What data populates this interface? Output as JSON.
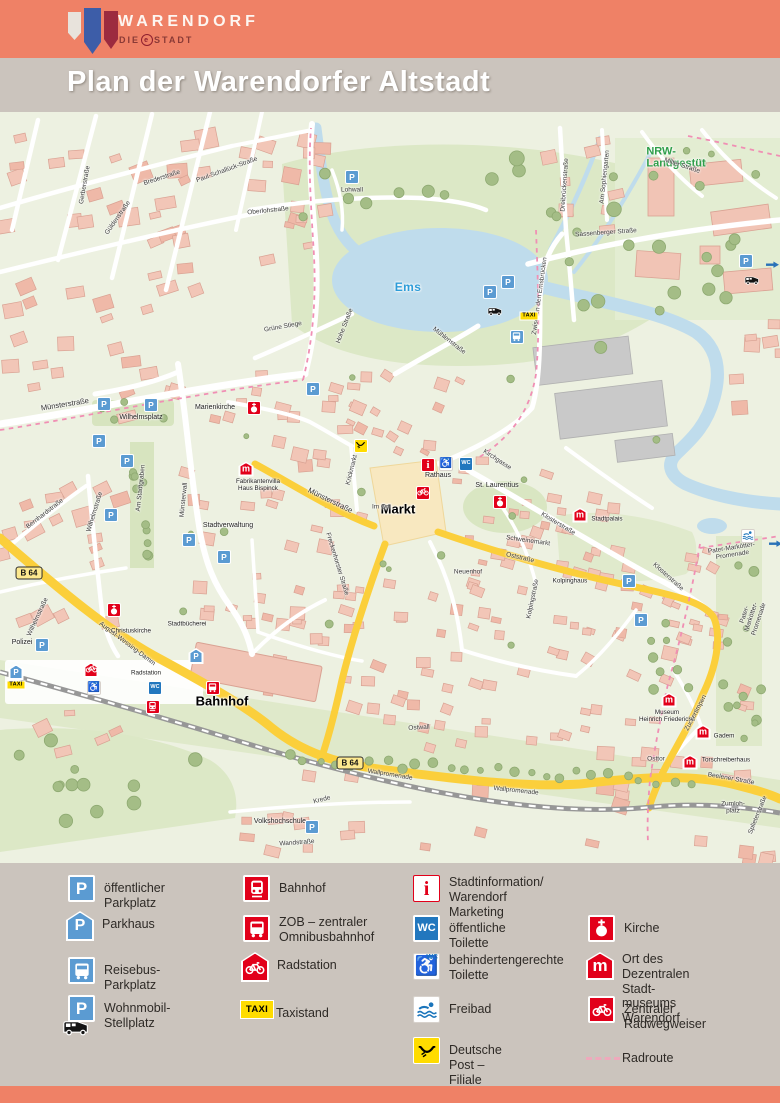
{
  "header": {
    "brand": "WARENDORF",
    "sub_prefix": "DIE",
    "sub_e": "e",
    "sub_suffix": "STADT"
  },
  "title": "Plan der Warendorfer Altstadt",
  "glyphs": {
    "p": "P",
    "wc": "WC",
    "taxi": "TAXI",
    "museum": "m",
    "info": "i",
    "wheelchair": "♿",
    "b64": "B 64"
  },
  "colors": {
    "header": "#EF8166",
    "band": "#CBC4BD",
    "p_blue": "#5B9BD2",
    "wc_blue": "#2277BE",
    "red": "#E2001A",
    "taxi_yellow": "#FFDC00",
    "road_yellow": "#FBCF3B",
    "water": "#BFDCEC",
    "radroute_pink": "#F08FB4",
    "nrw_green": "#2E9E49"
  },
  "map": {
    "labels": [
      {
        "text": "Ems",
        "x": 408,
        "y": 176,
        "rot": 0,
        "cls": "water"
      },
      {
        "text": "NRW-\nLandgestüt",
        "x": 676,
        "y": 46,
        "rot": 0,
        "cls": "green"
      },
      {
        "text": "Markt",
        "x": 398,
        "y": 398,
        "rot": 0,
        "cls": "big"
      },
      {
        "text": "Rathaus",
        "x": 438,
        "y": 364,
        "rot": 0,
        "cls": "poi"
      },
      {
        "text": "St. Laurentius",
        "x": 497,
        "y": 374,
        "rot": 0,
        "cls": "poi"
      },
      {
        "text": "Bahnhof",
        "x": 222,
        "y": 590,
        "rot": 0,
        "cls": "big"
      },
      {
        "text": "Polizei",
        "x": 22,
        "y": 531,
        "rot": 0,
        "cls": "poi"
      },
      {
        "text": "Marienkirche",
        "x": 215,
        "y": 296,
        "rot": 0,
        "cls": "poi"
      },
      {
        "text": "Stadtverwaltung",
        "x": 228,
        "y": 414,
        "rot": 0,
        "cls": "poi"
      },
      {
        "text": "Fabrikantenvilla\nHaus Bispinck",
        "x": 258,
        "y": 373,
        "rot": 0,
        "cls": "poi-sm"
      },
      {
        "text": "Museum\nHeinrich Friederichs",
        "x": 667,
        "y": 604,
        "rot": 0,
        "cls": "poi-sm"
      },
      {
        "text": "Gadem",
        "x": 724,
        "y": 624,
        "rot": 0,
        "cls": "poi-sm"
      },
      {
        "text": "Torschreiberhaus",
        "x": 726,
        "y": 648,
        "rot": 0,
        "cls": "poi-sm"
      },
      {
        "text": "Wilhelmsplatz",
        "x": 141,
        "y": 306,
        "rot": 0,
        "cls": "poi"
      },
      {
        "text": "Volkshochschule",
        "x": 280,
        "y": 710,
        "rot": 0,
        "cls": "poi"
      },
      {
        "text": "Kolpinghaus",
        "x": 570,
        "y": 469,
        "rot": 0,
        "cls": "poi-sm"
      },
      {
        "text": "Stadtpalais",
        "x": 607,
        "y": 407,
        "rot": 0,
        "cls": "poi-sm"
      },
      {
        "text": "Schweinemarkt",
        "x": 528,
        "y": 429,
        "rot": 8,
        "cls": "street"
      },
      {
        "text": "Münsterstraße",
        "x": 65,
        "y": 293,
        "rot": -9,
        "cls": "street-lg"
      },
      {
        "text": "Münsterstraße",
        "x": 330,
        "y": 389,
        "rot": 26,
        "cls": "street-lg"
      },
      {
        "text": "Freckenhorster Straße",
        "x": 337,
        "y": 452,
        "rot": 73,
        "cls": "street"
      },
      {
        "text": "Wilhelmstraße",
        "x": 95,
        "y": 400,
        "rot": -73,
        "cls": "street"
      },
      {
        "text": "Wilhelmstraße",
        "x": 38,
        "y": 505,
        "rot": -65,
        "cls": "street"
      },
      {
        "text": "Bernhardstraße",
        "x": 45,
        "y": 402,
        "rot": -38,
        "cls": "street"
      },
      {
        "text": "Am Stadtgraben",
        "x": 141,
        "y": 376,
        "rot": -84,
        "cls": "street"
      },
      {
        "text": "Münsterwall",
        "x": 184,
        "y": 388,
        "rot": -84,
        "cls": "street"
      },
      {
        "text": "Brederstraße",
        "x": 162,
        "y": 66,
        "rot": -18,
        "cls": "street"
      },
      {
        "text": "Gerberstraße",
        "x": 85,
        "y": 73,
        "rot": -80,
        "cls": "street"
      },
      {
        "text": "Güldenstraße",
        "x": 118,
        "y": 106,
        "rot": -55,
        "cls": "street"
      },
      {
        "text": "Paul-Schallück-Straße",
        "x": 227,
        "y": 58,
        "rot": -20,
        "cls": "street"
      },
      {
        "text": "Dreibrückenstraße",
        "x": 565,
        "y": 73,
        "rot": -86,
        "cls": "street"
      },
      {
        "text": "Am Sophiengarten",
        "x": 605,
        "y": 65,
        "rot": -84,
        "cls": "street"
      },
      {
        "text": "Sassenberger Straße",
        "x": 606,
        "y": 121,
        "rot": -4,
        "cls": "street"
      },
      {
        "text": "Milter Straße",
        "x": 682,
        "y": 54,
        "rot": 18,
        "cls": "street"
      },
      {
        "text": "Lohwall",
        "x": 352,
        "y": 78,
        "rot": 0,
        "cls": "street"
      },
      {
        "text": "Oberlohstraße",
        "x": 268,
        "y": 99,
        "rot": -6,
        "cls": "street"
      },
      {
        "text": "Hohe Straße",
        "x": 345,
        "y": 214,
        "rot": -69,
        "cls": "street"
      },
      {
        "text": "Grüne Stiege",
        "x": 283,
        "y": 215,
        "rot": -10,
        "cls": "street"
      },
      {
        "text": "Mühlenstraße",
        "x": 449,
        "y": 229,
        "rot": 38,
        "cls": "street"
      },
      {
        "text": "Zwischen den Emsbrücken",
        "x": 540,
        "y": 184,
        "rot": -82,
        "cls": "street"
      },
      {
        "text": "Kirchgasse",
        "x": 497,
        "y": 348,
        "rot": 33,
        "cls": "street"
      },
      {
        "text": "Klosterstraße",
        "x": 558,
        "y": 412,
        "rot": 31,
        "cls": "street"
      },
      {
        "text": "Klosterstraße",
        "x": 668,
        "y": 465,
        "rot": 42,
        "cls": "street"
      },
      {
        "text": "Krickmarkt",
        "x": 352,
        "y": 358,
        "rot": -76,
        "cls": "street"
      },
      {
        "text": "Im Ort",
        "x": 381,
        "y": 395,
        "rot": 0,
        "cls": "street"
      },
      {
        "text": "Oststraße",
        "x": 520,
        "y": 446,
        "rot": 13,
        "cls": "street"
      },
      {
        "text": "Ostwall",
        "x": 419,
        "y": 616,
        "rot": -3,
        "cls": "street"
      },
      {
        "text": "Wallpromenade",
        "x": 390,
        "y": 663,
        "rot": 9,
        "cls": "street"
      },
      {
        "text": "Wallpromenade",
        "x": 516,
        "y": 679,
        "rot": 6,
        "cls": "street"
      },
      {
        "text": "August-Wessing-Damm",
        "x": 127,
        "y": 532,
        "rot": 37,
        "cls": "street"
      },
      {
        "text": "Stadtbücherei",
        "x": 187,
        "y": 512,
        "rot": 0,
        "cls": "poi-sm"
      },
      {
        "text": "Christuskirche",
        "x": 131,
        "y": 519,
        "rot": 0,
        "cls": "poi-sm"
      },
      {
        "text": "Radstation",
        "x": 146,
        "y": 561,
        "rot": 0,
        "cls": "poi-sm"
      },
      {
        "text": "Splieterstraße",
        "x": 758,
        "y": 703,
        "rot": -68,
        "cls": "street"
      },
      {
        "text": "Zumloh-\nplatz",
        "x": 733,
        "y": 696,
        "rot": 0,
        "cls": "street"
      },
      {
        "text": "Beelener Straße",
        "x": 731,
        "y": 667,
        "rot": 10,
        "cls": "street"
      },
      {
        "text": "Pater-Markötter-Promenade",
        "x": 732,
        "y": 440,
        "rot": -9,
        "cls": "street"
      },
      {
        "text": "Pater-Markötter-Promenade",
        "x": 752,
        "y": 505,
        "rot": -72,
        "cls": "street"
      },
      {
        "text": "Krede",
        "x": 322,
        "y": 688,
        "rot": -14,
        "cls": "street"
      },
      {
        "text": "Wandstraße",
        "x": 297,
        "y": 731,
        "rot": -4,
        "cls": "street"
      },
      {
        "text": "Kolpingstraße",
        "x": 533,
        "y": 487,
        "rot": -78,
        "cls": "street"
      },
      {
        "text": "Zuckertimpen",
        "x": 696,
        "y": 601,
        "rot": -62,
        "cls": "street"
      },
      {
        "text": "Osttor",
        "x": 656,
        "y": 647,
        "rot": 0,
        "cls": "street"
      },
      {
        "text": "Neuenhof",
        "x": 468,
        "y": 460,
        "rot": 0,
        "cls": "street"
      },
      {
        "text": "B 64",
        "x": 29,
        "y": 461,
        "rot": 0,
        "cls": "b64"
      },
      {
        "text": "B 64",
        "x": 350,
        "y": 651,
        "rot": 0,
        "cls": "b64"
      }
    ],
    "icons": [
      {
        "type": "p",
        "x": 352,
        "y": 65
      },
      {
        "type": "p",
        "x": 490,
        "y": 180
      },
      {
        "type": "p",
        "x": 508,
        "y": 170
      },
      {
        "type": "p",
        "x": 746,
        "y": 149
      },
      {
        "type": "p",
        "x": 313,
        "y": 277
      },
      {
        "type": "p",
        "x": 104,
        "y": 292
      },
      {
        "type": "p",
        "x": 151,
        "y": 293
      },
      {
        "type": "p",
        "x": 99,
        "y": 329
      },
      {
        "type": "p",
        "x": 127,
        "y": 349
      },
      {
        "type": "p",
        "x": 111,
        "y": 403
      },
      {
        "type": "p",
        "x": 189,
        "y": 428
      },
      {
        "type": "p",
        "x": 224,
        "y": 445
      },
      {
        "type": "p",
        "x": 629,
        "y": 469
      },
      {
        "type": "p",
        "x": 641,
        "y": 508
      },
      {
        "type": "p",
        "x": 42,
        "y": 533
      },
      {
        "type": "p",
        "x": 312,
        "y": 715
      },
      {
        "type": "parkhaus",
        "x": 16,
        "y": 560
      },
      {
        "type": "parkhaus",
        "x": 196,
        "y": 544
      },
      {
        "type": "camper",
        "x": 744,
        "y": 164
      },
      {
        "type": "camper",
        "x": 487,
        "y": 195
      },
      {
        "type": "taxi",
        "x": 529,
        "y": 204
      },
      {
        "type": "taxi",
        "x": 16,
        "y": 573
      },
      {
        "type": "reisebus",
        "x": 517,
        "y": 225
      },
      {
        "type": "zob",
        "x": 213,
        "y": 576
      },
      {
        "type": "bahnhof",
        "x": 153,
        "y": 595
      },
      {
        "type": "radstation",
        "x": 91,
        "y": 558
      },
      {
        "type": "info",
        "x": 428,
        "y": 353
      },
      {
        "type": "wcb",
        "x": 446,
        "y": 352
      },
      {
        "type": "wcb",
        "x": 94,
        "y": 576
      },
      {
        "type": "wc",
        "x": 466,
        "y": 352
      },
      {
        "type": "wc",
        "x": 155,
        "y": 576
      },
      {
        "type": "radweg",
        "x": 423,
        "y": 381
      },
      {
        "type": "kirche",
        "x": 500,
        "y": 390
      },
      {
        "type": "kirche",
        "x": 254,
        "y": 296
      },
      {
        "type": "kirche",
        "x": 114,
        "y": 498
      },
      {
        "type": "museum",
        "x": 246,
        "y": 357
      },
      {
        "type": "museum",
        "x": 580,
        "y": 403
      },
      {
        "type": "museum",
        "x": 669,
        "y": 588
      },
      {
        "type": "museum",
        "x": 703,
        "y": 620
      },
      {
        "type": "museum",
        "x": 690,
        "y": 650
      },
      {
        "type": "post",
        "x": 361,
        "y": 334
      },
      {
        "type": "freibad",
        "x": 748,
        "y": 424
      },
      {
        "type": "arrow",
        "x": 766,
        "y": 149
      },
      {
        "type": "arrow",
        "x": 769,
        "y": 428
      }
    ]
  },
  "legend": {
    "items": [
      {
        "type": "p",
        "label": "öffentlicher Parkplatz"
      },
      {
        "type": "parkhaus",
        "label": "Parkhaus"
      },
      {
        "type": "reisebus",
        "label": "Reisebus-Parkplatz"
      },
      {
        "type": "wohnmobil",
        "label": "Wohnmobil-Stellplatz"
      },
      {
        "type": "bahnhof",
        "label": "Bahnhof"
      },
      {
        "type": "zob",
        "label": "ZOB – zentraler\nOmnibusbahnhof"
      },
      {
        "type": "radstation",
        "label": "Radstation"
      },
      {
        "type": "taxi",
        "label": "Taxistand"
      },
      {
        "type": "info",
        "label": "Stadtinformation/\nWarendorf Marketing"
      },
      {
        "type": "wc",
        "label": "öffentliche Toilette"
      },
      {
        "type": "wcb",
        "label": "behindertengerechte\nToilette"
      },
      {
        "type": "freibad",
        "label": "Freibad"
      },
      {
        "type": "post",
        "label": "Deutsche Post – Filiale"
      },
      {
        "type": "kirche",
        "label": "Kirche"
      },
      {
        "type": "museum",
        "label": "Ort des Dezentralen Stadt-\nmuseums Warendorf"
      },
      {
        "type": "radweg",
        "label": "Zentraler Radwegweiser"
      },
      {
        "type": "radroute",
        "label": "Radroute"
      }
    ]
  }
}
